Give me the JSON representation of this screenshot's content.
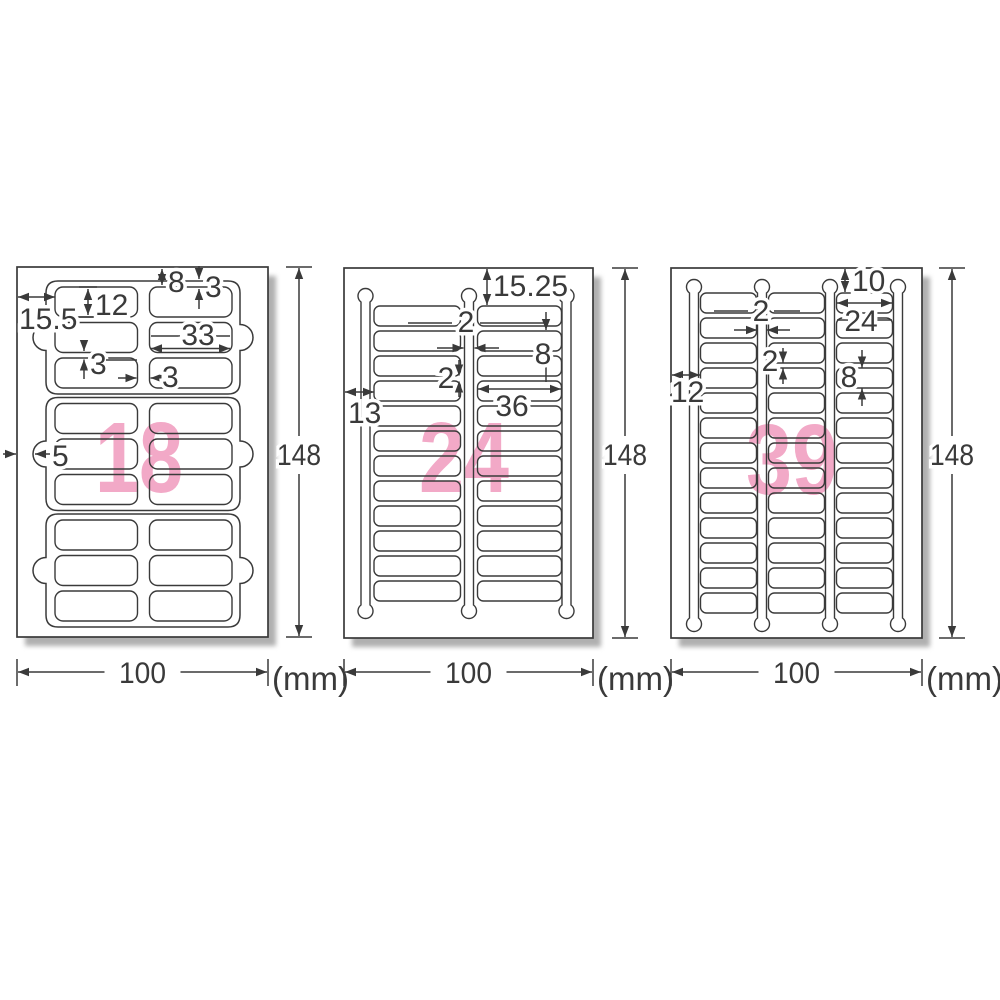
{
  "unit_label": "(mm)",
  "colors": {
    "line": "#3a3a3a",
    "count_pink": "#f2a9c7",
    "shadow": "#b0b0b0",
    "paper": "#ffffff"
  },
  "sheets": [
    {
      "count": "18",
      "width_mm": "100",
      "height_mm": "148",
      "grid": {
        "columns": 2,
        "rows": 9,
        "groups": 3
      },
      "dims": {
        "left_margin": "15.5",
        "label_height": "12",
        "top_margin": "8",
        "edge_gap": "3",
        "label_width": "33",
        "row_gap": "3",
        "col_gap": "3",
        "tab_width": "5"
      }
    },
    {
      "count": "24",
      "width_mm": "100",
      "height_mm": "148",
      "grid": {
        "columns": 2,
        "rows": 12
      },
      "dims": {
        "top_margin": "15.25",
        "col_gap": "2",
        "label_height": "8",
        "row_gap": "2",
        "left_margin": "13",
        "label_width": "36"
      }
    },
    {
      "count": "39",
      "width_mm": "100",
      "height_mm": "148",
      "grid": {
        "columns": 3,
        "rows": 13
      },
      "dims": {
        "top_margin": "10",
        "col_gap": "2",
        "label_width": "24",
        "row_gap": "2",
        "label_height": "8",
        "left_margin": "12"
      }
    }
  ]
}
